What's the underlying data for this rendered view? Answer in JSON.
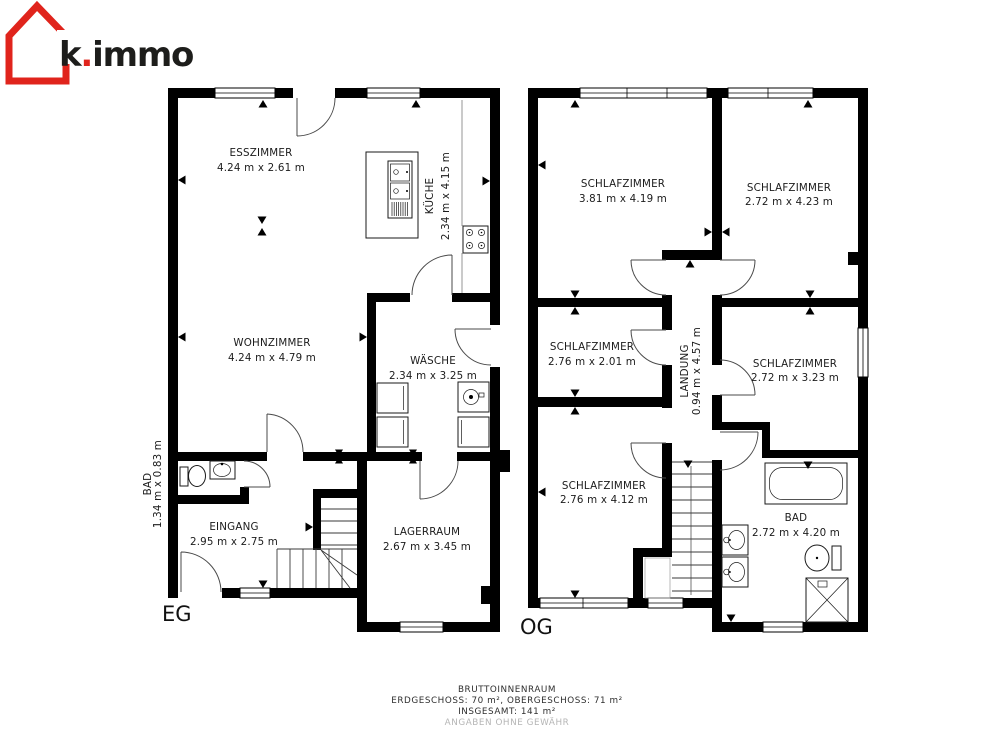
{
  "logo": {
    "part1": "k",
    "dot": ".",
    "part2": "immo"
  },
  "plans": {
    "eg": {
      "floor_label": "EG",
      "rooms": [
        {
          "name": "ESSZIMMER",
          "dims": "4.24 m x 2.61 m"
        },
        {
          "name": "KÜCHE",
          "dims": "2.34 m x 4.15 m"
        },
        {
          "name": "WOHNZIMMER",
          "dims": "4.24 m x 4.79 m"
        },
        {
          "name": "WÄSCHE",
          "dims": "2.34 m x 3.25 m"
        },
        {
          "name": "BAD",
          "dims": "1.34 m x 0.83 m"
        },
        {
          "name": "EINGANG",
          "dims": "2.95 m x 2.75 m"
        },
        {
          "name": "LAGERRAUM",
          "dims": "2.67 m x 3.45 m"
        }
      ]
    },
    "og": {
      "floor_label": "OG",
      "rooms": [
        {
          "name": "SCHLAFZIMMER",
          "dims": "3.81 m x 4.19 m"
        },
        {
          "name": "SCHLAFZIMMER",
          "dims": "2.72 m x 4.23 m"
        },
        {
          "name": "SCHLAFZIMMER",
          "dims": "2.76 m x 2.01 m"
        },
        {
          "name": "LANDUNG",
          "dims": "0.94 m x 4.57 m"
        },
        {
          "name": "SCHLAFZIMMER",
          "dims": "2.72 m x 3.23 m"
        },
        {
          "name": "SCHLAFZIMMER",
          "dims": "2.76 m x 4.12 m"
        },
        {
          "name": "BAD",
          "dims": "2.72 m x 4.20 m"
        }
      ]
    }
  },
  "footer": {
    "line1": "BRUTTOINNENRAUM",
    "line2": "ERDGESCHOSS: 70 m², OBERGESCHOSS: 71 m²",
    "line3": "INSGESAMT: 141 m²",
    "line4": "ANGABEN OHNE GEWÄHR"
  },
  "colors": {
    "brand_red": "#e0241c",
    "wall_black": "#000000",
    "text_dark": "#1b1b1b",
    "muted_gray": "#b5b5b5"
  }
}
